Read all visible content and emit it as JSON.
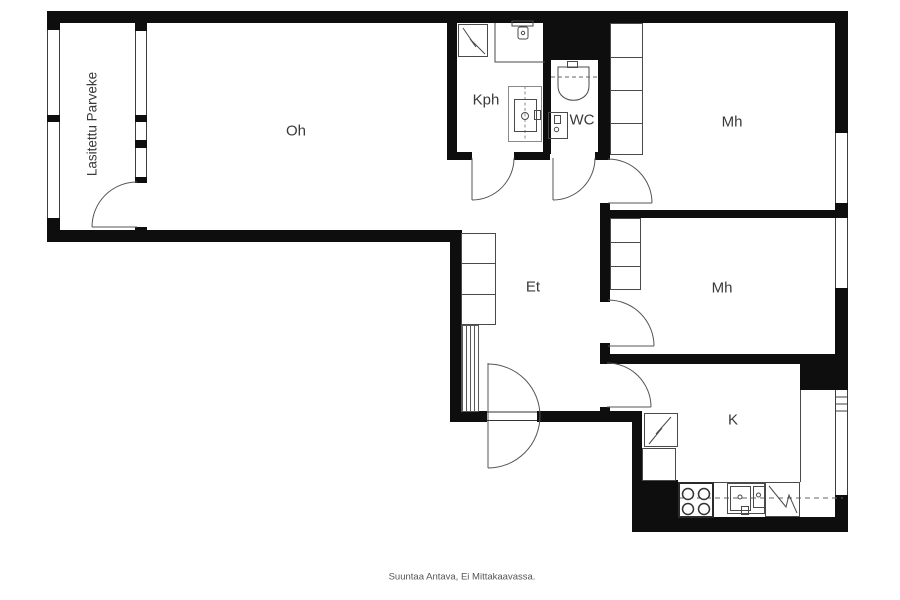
{
  "plan": {
    "caption": "Suuntaa Antava, Ei Mittakaavassa.",
    "rooms": {
      "balcony": {
        "label": "Lasitettu Parveke"
      },
      "living_room": {
        "label": "Oh"
      },
      "bathroom": {
        "label": "Kph"
      },
      "toilet_room": {
        "label": "WC"
      },
      "bedroom_top": {
        "label": "Mh"
      },
      "bedroom_middle": {
        "label": "Mh"
      },
      "hallway": {
        "label": "Et"
      },
      "kitchen": {
        "label": "K"
      }
    },
    "symbols": {
      "electrical_cabinet": "zigzag-box",
      "shower_corner": "l-shaped-lines",
      "washbasin": "basin-with-tap-bar",
      "washing_machine": "box-with-drum-circle",
      "toilet": "cistern-and-bowl",
      "wc_sink": "small-basin",
      "stove": "four-burner-rings",
      "kitchen_sink": "double-basin",
      "dishwasher": "zigzag-box",
      "fridge": "zigzag-box",
      "wardrobe": "sectioned-cabinet",
      "coat_rack": "hatched-strip",
      "door": "quarter-circle-swing",
      "entrance_door": "double-swing-semicircle"
    },
    "colors": {
      "wall": "#0e0e0e",
      "fixture_line": "#4a4a4a",
      "door_line": "#555555",
      "label_text": "#3a3a3a",
      "caption_text": "#555555",
      "background": "#ffffff"
    }
  }
}
